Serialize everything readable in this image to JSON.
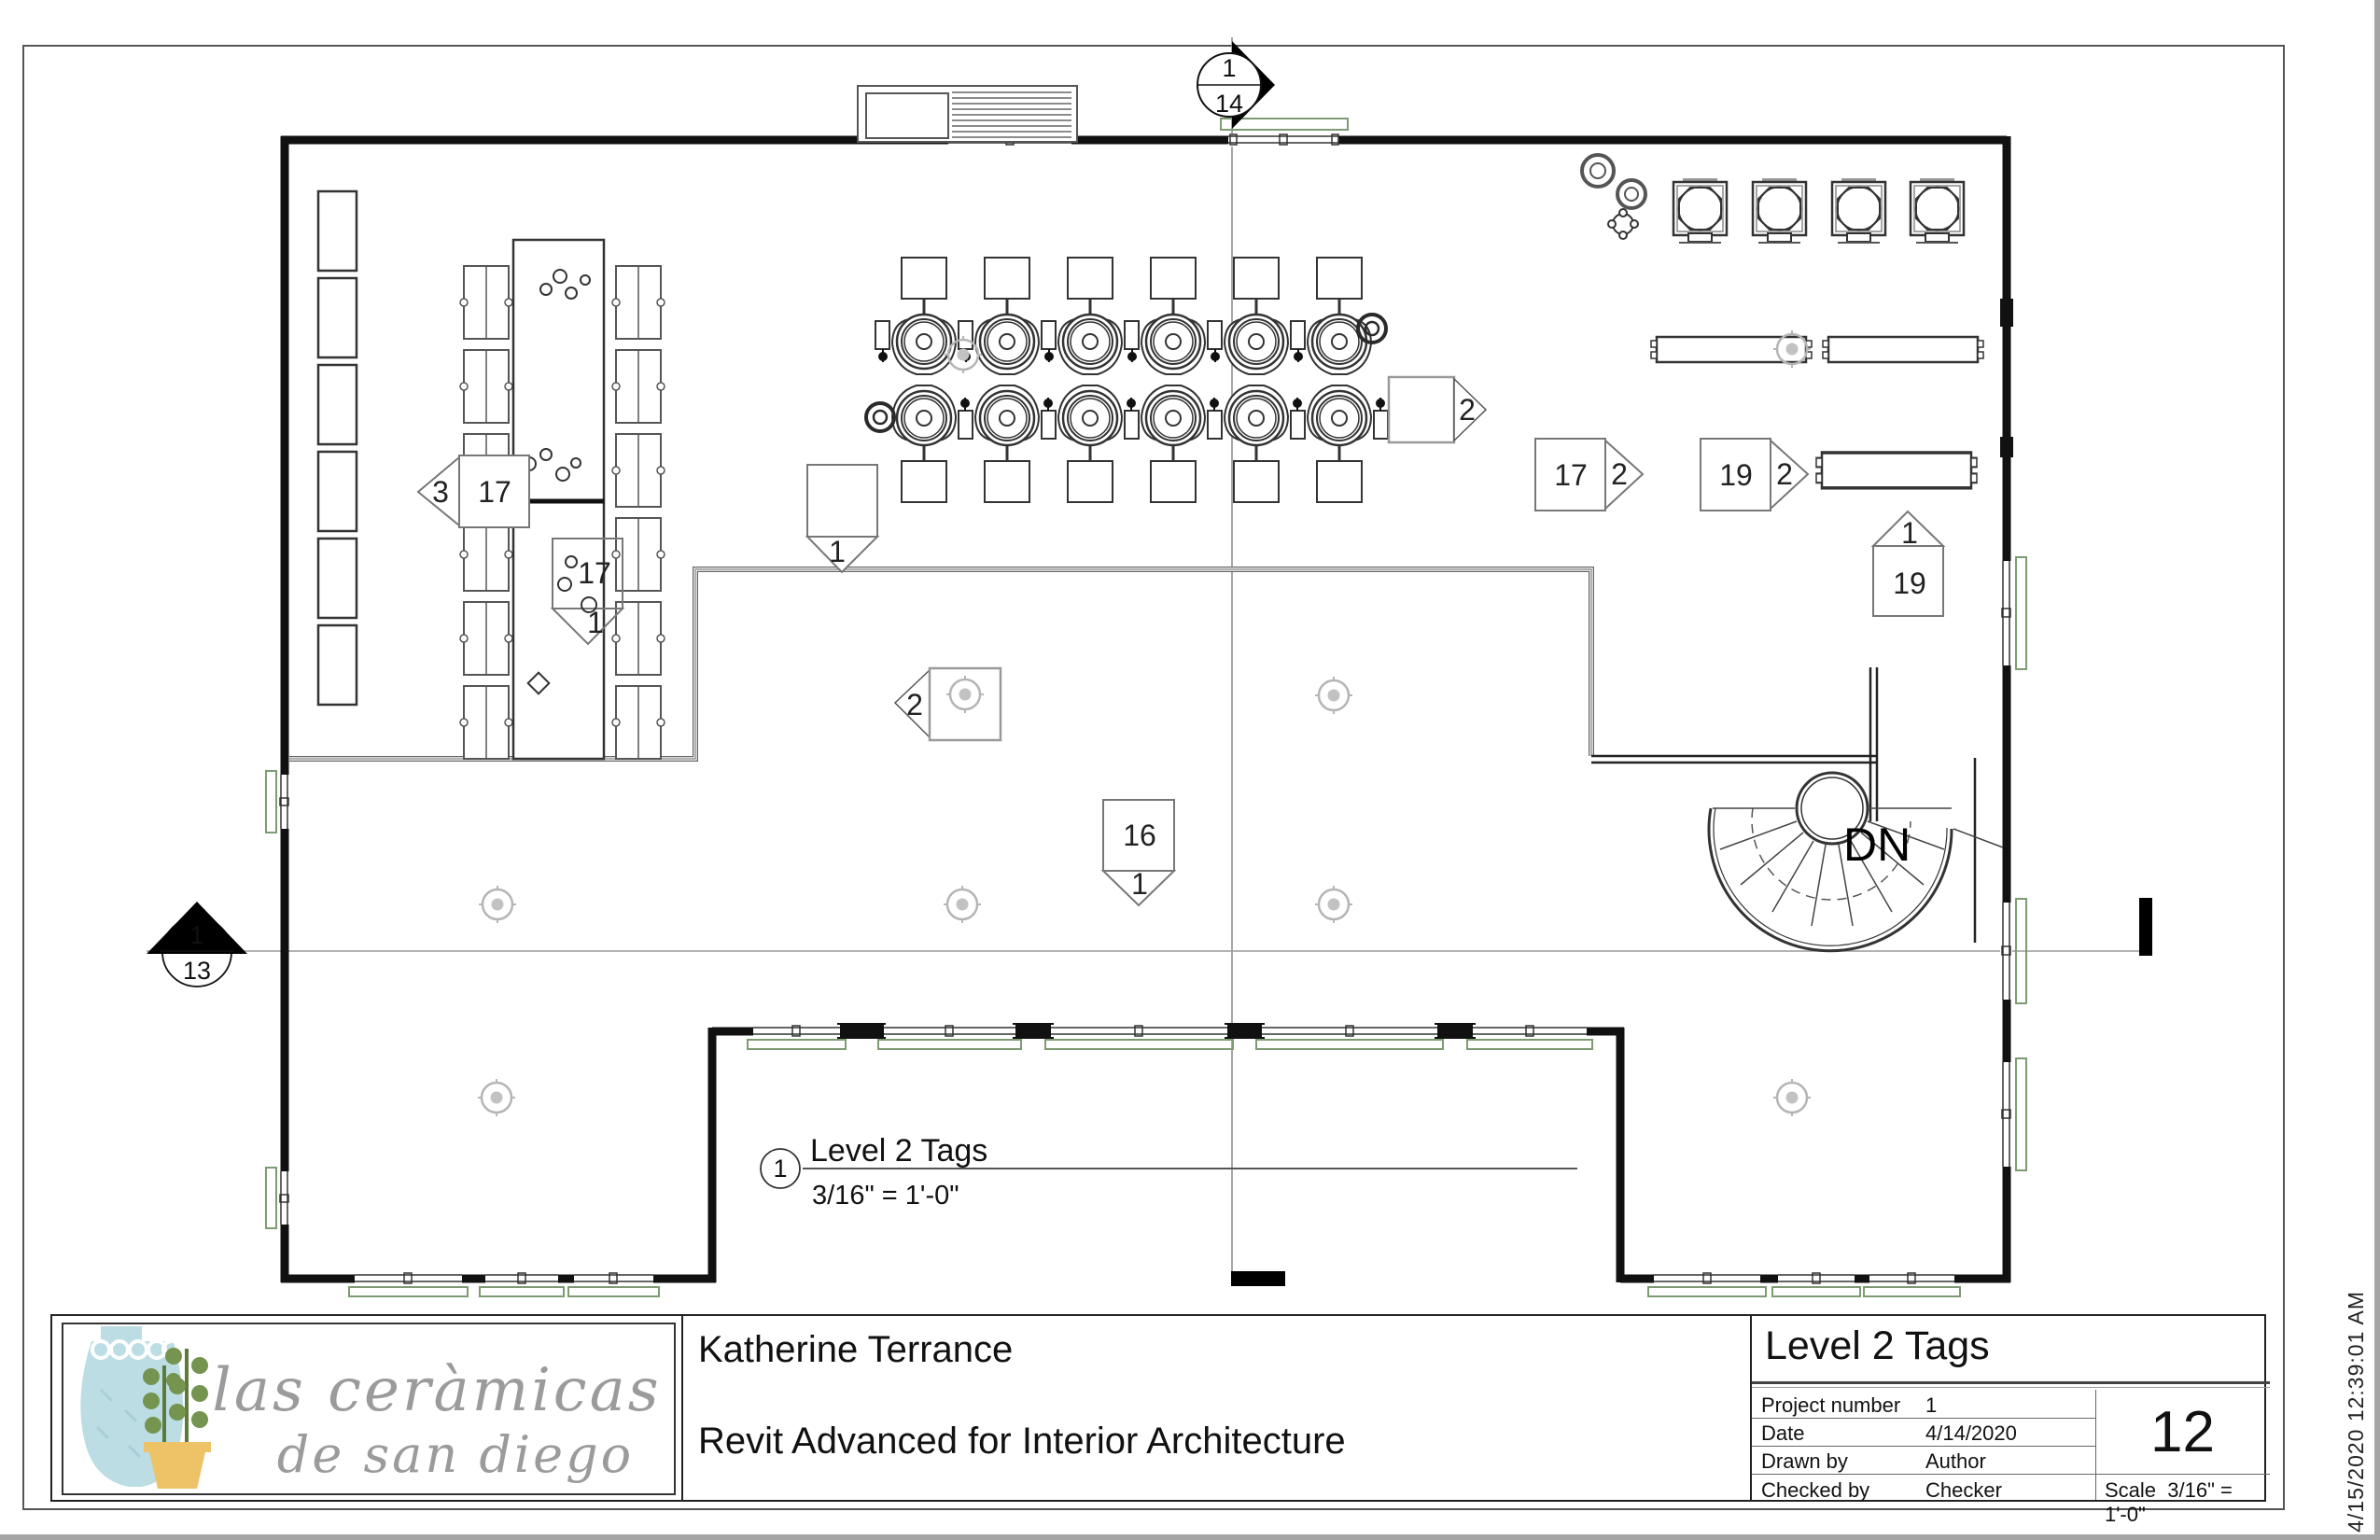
{
  "page": {
    "timestamp": "4/15/2020 12:39:01 AM"
  },
  "view_title": {
    "number": "1",
    "title": "Level 2 Tags",
    "scale": "3/16\" = 1'-0\""
  },
  "markers": {
    "top_section": {
      "detail_number": "1",
      "sheet_number": "14"
    },
    "left_section": {
      "detail_number": "1",
      "sheet_number": "13"
    }
  },
  "plan": {
    "stair_direction_label": "DN",
    "tags": {
      "shelf_left": {
        "arrow": "3",
        "box": "17"
      },
      "table_left": {
        "box": "17",
        "arrow": "1"
      },
      "room_boundary": {
        "arrow": "1"
      },
      "room_left": {
        "arrow": "2"
      },
      "wheels_right": {
        "arrow": "2"
      },
      "kiln_area_a": {
        "box": "17",
        "arrow": "2"
      },
      "kiln_area_b": {
        "box": "19",
        "arrow": "2"
      },
      "shelf_right": {
        "arrow": "1",
        "box": "19"
      },
      "hall_center": {
        "box": "16",
        "arrow": "1"
      }
    }
  },
  "title_block": {
    "logo": {
      "line1": "las ceràmicas",
      "line2": "de san diego"
    },
    "client_name": "Katherine Terrance",
    "project_name": "Revit Advanced for Interior Architecture",
    "sheet_title": "Level 2 Tags",
    "fields": [
      {
        "label": "Project number",
        "value": "1"
      },
      {
        "label": "Date",
        "value": "4/14/2020"
      },
      {
        "label": "Drawn by",
        "value": "Author"
      },
      {
        "label": "Checked by",
        "value": "Checker"
      }
    ],
    "sheet_number": "12",
    "scale_label": "Scale",
    "scale_value": "3/16\" = 1'-0\""
  },
  "colors": {
    "wall": "#1a1a1a",
    "window_trim": "#7d9b72",
    "annotation": "#777777"
  }
}
